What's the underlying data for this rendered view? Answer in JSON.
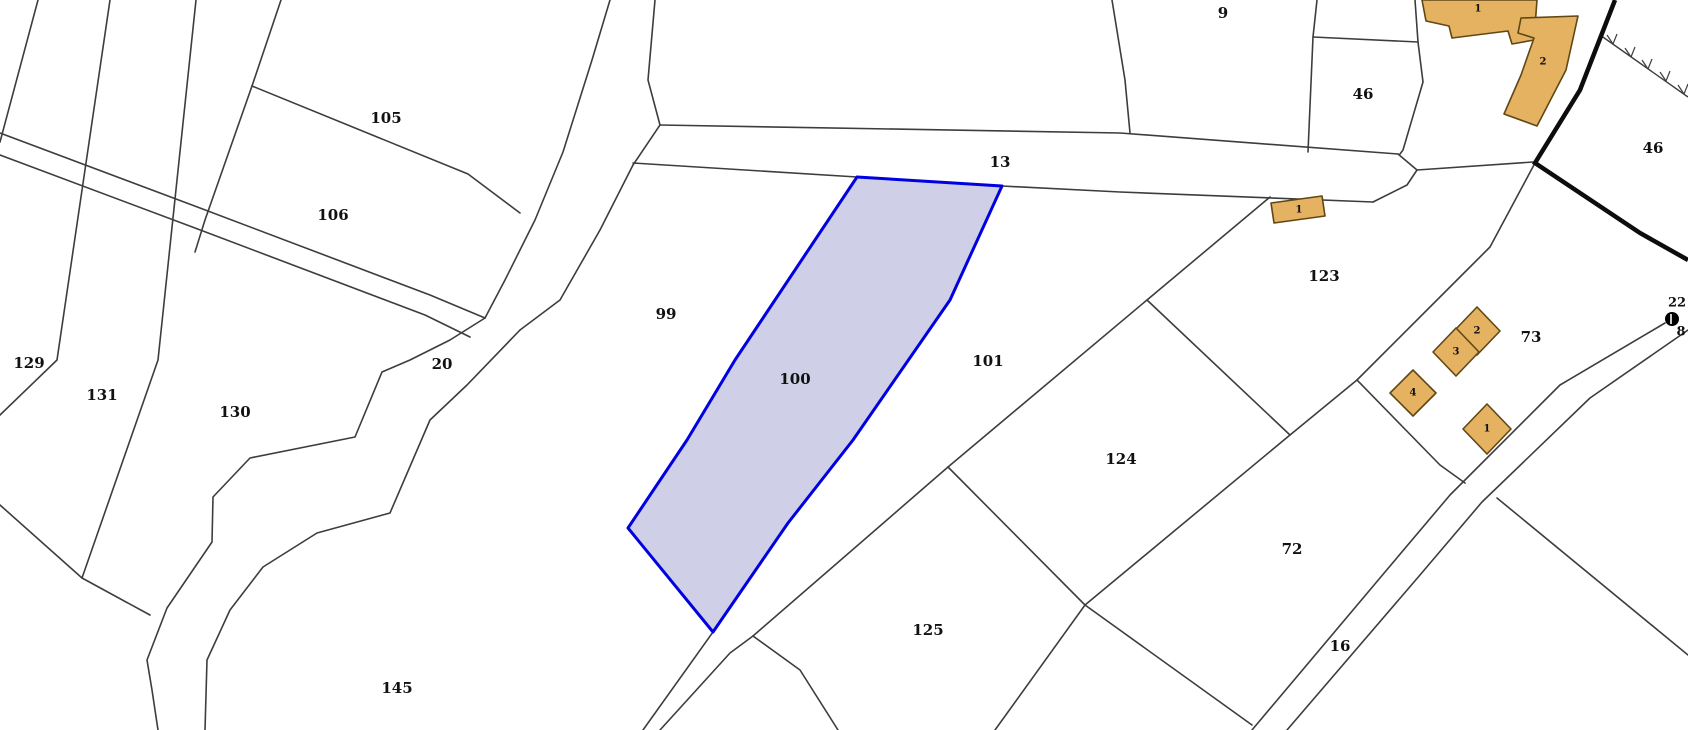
{
  "map": {
    "width": 1688,
    "height": 730,
    "background": "#ffffff",
    "colors": {
      "parcel_line": "#3d3d3d",
      "thick_boundary": "#0d0d0d",
      "highlight_stroke": "#0000e0",
      "highlight_fill": "#cbcbe5",
      "building_fill": "#e5b262",
      "building_stroke": "#5f4716",
      "label_color": "#111111"
    },
    "highlighted_parcel": {
      "number": "100",
      "label_x": 795,
      "label_y": 379,
      "points": [
        [
          857,
          177
        ],
        [
          1002,
          186
        ],
        [
          950,
          300
        ],
        [
          853,
          440
        ],
        [
          788,
          523
        ],
        [
          713,
          632
        ],
        [
          628,
          528
        ],
        [
          687,
          440
        ],
        [
          735,
          360
        ]
      ]
    },
    "parcel_labels": [
      {
        "text": "105",
        "x": 386,
        "y": 118
      },
      {
        "text": "106",
        "x": 333,
        "y": 215
      },
      {
        "text": "129",
        "x": 29,
        "y": 363
      },
      {
        "text": "131",
        "x": 102,
        "y": 395
      },
      {
        "text": "130",
        "x": 235,
        "y": 412
      },
      {
        "text": "20",
        "x": 442,
        "y": 364
      },
      {
        "text": "99",
        "x": 666,
        "y": 314
      },
      {
        "text": "101",
        "x": 988,
        "y": 361
      },
      {
        "text": "13",
        "x": 1000,
        "y": 162
      },
      {
        "text": "9",
        "x": 1223,
        "y": 13
      },
      {
        "text": "46",
        "x": 1363,
        "y": 94
      },
      {
        "text": "46",
        "x": 1653,
        "y": 148
      },
      {
        "text": "123",
        "x": 1324,
        "y": 276
      },
      {
        "text": "124",
        "x": 1121,
        "y": 459
      },
      {
        "text": "125",
        "x": 928,
        "y": 630
      },
      {
        "text": "145",
        "x": 397,
        "y": 688
      },
      {
        "text": "72",
        "x": 1292,
        "y": 549
      },
      {
        "text": "73",
        "x": 1531,
        "y": 337
      },
      {
        "text": "16",
        "x": 1340,
        "y": 646
      }
    ],
    "boundary_lines": [
      {
        "name": "strip-line-0",
        "points": [
          [
            38,
            0
          ],
          [
            0,
            142
          ]
        ]
      },
      {
        "name": "strip-line-1",
        "points": [
          [
            110,
            0
          ],
          [
            57,
            360
          ],
          [
            0,
            415
          ]
        ]
      },
      {
        "name": "strip-line-2",
        "points": [
          [
            196,
            0
          ],
          [
            158,
            360
          ],
          [
            82,
            578
          ]
        ]
      },
      {
        "name": "strip-line-3",
        "points": [
          [
            281,
            0
          ],
          [
            252,
            86
          ],
          [
            205,
            220
          ],
          [
            195,
            252
          ]
        ]
      },
      {
        "name": "strip-end-line",
        "points": [
          [
            0,
            505
          ],
          [
            82,
            578
          ],
          [
            150,
            615
          ]
        ]
      },
      {
        "name": "divider-105-106",
        "points": [
          [
            252,
            86
          ],
          [
            468,
            174
          ],
          [
            520,
            213
          ]
        ]
      },
      {
        "name": "road-20-west-edge",
        "points": [
          [
            0,
            133
          ],
          [
            200,
            208
          ],
          [
            430,
            295
          ],
          [
            485,
            318
          ]
        ]
      },
      {
        "name": "road-20-east-edge",
        "points": [
          [
            0,
            155
          ],
          [
            195,
            228
          ],
          [
            425,
            315
          ],
          [
            470,
            337
          ]
        ]
      },
      {
        "name": "road-north-left-edge",
        "points": [
          [
            610,
            0
          ],
          [
            592,
            60
          ],
          [
            563,
            152
          ],
          [
            535,
            220
          ],
          [
            505,
            280
          ],
          [
            485,
            318
          ]
        ]
      },
      {
        "name": "road-north-right-edge",
        "points": [
          [
            655,
            0
          ],
          [
            648,
            80
          ],
          [
            660,
            125
          ],
          [
            633,
            165
          ],
          [
            600,
            230
          ],
          [
            560,
            300
          ],
          [
            520,
            330
          ]
        ]
      },
      {
        "name": "stream-left-bank",
        "points": [
          [
            485,
            318
          ],
          [
            450,
            340
          ],
          [
            410,
            360
          ],
          [
            382,
            372
          ],
          [
            355,
            437
          ],
          [
            250,
            458
          ],
          [
            213,
            497
          ],
          [
            212,
            542
          ],
          [
            167,
            608
          ],
          [
            147,
            660
          ],
          [
            152,
            690
          ],
          [
            158,
            730
          ]
        ]
      },
      {
        "name": "stream-right-bank",
        "points": [
          [
            520,
            330
          ],
          [
            467,
            385
          ],
          [
            430,
            420
          ],
          [
            390,
            513
          ],
          [
            317,
            533
          ],
          [
            263,
            567
          ],
          [
            230,
            610
          ],
          [
            207,
            660
          ],
          [
            205,
            730
          ]
        ]
      },
      {
        "name": "road-13-north-edge",
        "points": [
          [
            660,
            125
          ],
          [
            1120,
            133
          ],
          [
            1398,
            154
          ]
        ]
      },
      {
        "name": "road-13-south-edge",
        "points": [
          [
            633,
            163
          ],
          [
            857,
            177
          ],
          [
            1002,
            186
          ],
          [
            1120,
            192
          ],
          [
            1373,
            202
          ]
        ]
      },
      {
        "name": "road-13-end-tip",
        "points": [
          [
            1398,
            154
          ],
          [
            1417,
            170
          ],
          [
            1407,
            185
          ],
          [
            1373,
            202
          ]
        ]
      },
      {
        "name": "tip-to-boundary-line",
        "points": [
          [
            1417,
            170
          ],
          [
            1533,
            162
          ]
        ]
      },
      {
        "name": "parcel-9-west-line",
        "points": [
          [
            1112,
            0
          ],
          [
            1125,
            80
          ],
          [
            1130,
            133
          ]
        ]
      },
      {
        "name": "parcel-46-west-line",
        "points": [
          [
            1317,
            0
          ],
          [
            1313,
            37
          ],
          [
            1308,
            152
          ]
        ]
      },
      {
        "name": "parcel-46-north-line",
        "points": [
          [
            1313,
            37
          ],
          [
            1418,
            42
          ]
        ]
      },
      {
        "name": "parcel-46-east-line",
        "points": [
          [
            1418,
            42
          ],
          [
            1423,
            82
          ],
          [
            1403,
            150
          ],
          [
            1400,
            154
          ]
        ]
      },
      {
        "name": "parcel-46-top-line",
        "points": [
          [
            1415,
            0
          ],
          [
            1418,
            42
          ]
        ]
      },
      {
        "name": "boundary-123-73",
        "points": [
          [
            1535,
            163
          ],
          [
            1490,
            247
          ],
          [
            1457,
            280
          ],
          [
            1357,
            380
          ]
        ]
      },
      {
        "name": "boundary-123-72",
        "points": [
          [
            1357,
            380
          ],
          [
            1290,
            435
          ]
        ]
      },
      {
        "name": "boundary-72-road",
        "points": [
          [
            1357,
            380
          ],
          [
            1440,
            465
          ],
          [
            1465,
            483
          ]
        ]
      },
      {
        "name": "boundary-101-123-124",
        "points": [
          [
            1270,
            197
          ],
          [
            1147,
            300
          ],
          [
            948,
            467
          ]
        ]
      },
      {
        "name": "boundary-123-124",
        "points": [
          [
            1147,
            300
          ],
          [
            1290,
            435
          ]
        ]
      },
      {
        "name": "boundary-72-124",
        "points": [
          [
            1290,
            435
          ],
          [
            1085,
            605
          ]
        ]
      },
      {
        "name": "boundary-124-125",
        "points": [
          [
            948,
            467
          ],
          [
            1085,
            605
          ]
        ]
      },
      {
        "name": "boundary-125-east",
        "points": [
          [
            1085,
            605
          ],
          [
            995,
            730
          ]
        ]
      },
      {
        "name": "boundary-72-south",
        "points": [
          [
            1085,
            605
          ],
          [
            1252,
            725
          ]
        ]
      },
      {
        "name": "boundary-101-125",
        "points": [
          [
            948,
            467
          ],
          [
            753,
            636
          ]
        ]
      },
      {
        "name": "lane-upper-edge",
        "points": [
          [
            713,
            632
          ],
          [
            643,
            730
          ]
        ]
      },
      {
        "name": "lane-lower-edge",
        "points": [
          [
            753,
            636
          ],
          [
            730,
            653
          ],
          [
            660,
            730
          ]
        ]
      },
      {
        "name": "boundary-125-west",
        "points": [
          [
            753,
            636
          ],
          [
            800,
            670
          ],
          [
            838,
            730
          ]
        ]
      },
      {
        "name": "road-16-west-edge",
        "points": [
          [
            1252,
            730
          ],
          [
            1385,
            572
          ],
          [
            1450,
            495
          ],
          [
            1560,
            385
          ],
          [
            1665,
            323
          ]
        ]
      },
      {
        "name": "road-16-east-edge",
        "points": [
          [
            1287,
            730
          ],
          [
            1420,
            575
          ],
          [
            1482,
            502
          ],
          [
            1590,
            398
          ],
          [
            1688,
            330
          ]
        ]
      },
      {
        "name": "boundary-southeast-branch",
        "points": [
          [
            1497,
            498
          ],
          [
            1688,
            655
          ]
        ]
      }
    ],
    "thick_boundary_line": {
      "points": [
        [
          1615,
          0
        ],
        [
          1580,
          90
        ],
        [
          1535,
          163
        ],
        [
          1640,
          233
        ],
        [
          1688,
          260
        ]
      ]
    },
    "fence_line": {
      "points": [
        [
          1600,
          35
        ],
        [
          1688,
          97
        ]
      ],
      "ticks": [
        [
          [
            1607,
            35
          ],
          [
            1613,
            44
          ]
        ],
        [
          [
            1617,
            34
          ],
          [
            1613,
            44
          ]
        ],
        [
          [
            1625,
            48
          ],
          [
            1631,
            57
          ]
        ],
        [
          [
            1635,
            47
          ],
          [
            1631,
            57
          ]
        ],
        [
          [
            1642,
            60
          ],
          [
            1648,
            69
          ]
        ],
        [
          [
            1652,
            59
          ],
          [
            1648,
            69
          ]
        ],
        [
          [
            1660,
            72
          ],
          [
            1666,
            81
          ]
        ],
        [
          [
            1670,
            71
          ],
          [
            1666,
            81
          ]
        ],
        [
          [
            1678,
            85
          ],
          [
            1684,
            94
          ]
        ],
        [
          [
            1688,
            84
          ],
          [
            1684,
            94
          ]
        ]
      ]
    },
    "buildings": [
      {
        "number": "1",
        "label_x": 1478,
        "label_y": 9,
        "points": [
          [
            1422,
            0
          ],
          [
            1426,
            21
          ],
          [
            1449,
            26
          ],
          [
            1452,
            38
          ],
          [
            1508,
            31
          ],
          [
            1512,
            44
          ],
          [
            1534,
            40
          ],
          [
            1537,
            0
          ]
        ]
      },
      {
        "number": "2",
        "label_x": 1543,
        "label_y": 62,
        "points": [
          [
            1521,
            18
          ],
          [
            1578,
            16
          ],
          [
            1566,
            70
          ],
          [
            1537,
            126
          ],
          [
            1504,
            114
          ],
          [
            1521,
            75
          ],
          [
            1534,
            38
          ],
          [
            1518,
            33
          ]
        ]
      },
      {
        "number": "1",
        "label_x": 1299,
        "label_y": 210,
        "points": [
          [
            1271,
            203
          ],
          [
            1322,
            196
          ],
          [
            1325,
            216
          ],
          [
            1274,
            223
          ]
        ]
      },
      {
        "number": "2",
        "label_x": 1477,
        "label_y": 331,
        "points": [
          [
            1477,
            307
          ],
          [
            1500,
            331
          ],
          [
            1477,
            355
          ],
          [
            1454,
            331
          ]
        ]
      },
      {
        "number": "3",
        "label_x": 1456,
        "label_y": 352,
        "points": [
          [
            1456,
            328
          ],
          [
            1479,
            352
          ],
          [
            1456,
            376
          ],
          [
            1433,
            352
          ]
        ]
      },
      {
        "number": "4",
        "label_x": 1413,
        "label_y": 393,
        "points": [
          [
            1413,
            370
          ],
          [
            1436,
            393
          ],
          [
            1413,
            416
          ],
          [
            1390,
            393
          ]
        ]
      },
      {
        "number": "1",
        "label_x": 1487,
        "label_y": 429,
        "points": [
          [
            1487,
            404
          ],
          [
            1511,
            429
          ],
          [
            1487,
            454
          ],
          [
            1463,
            429
          ]
        ]
      }
    ],
    "survey_point": {
      "x": 1672,
      "y": 319,
      "radius": 7,
      "labels": [
        {
          "text": "22",
          "x": 1677,
          "y": 303
        },
        {
          "text": "8",
          "x": 1681,
          "y": 332
        }
      ]
    }
  }
}
